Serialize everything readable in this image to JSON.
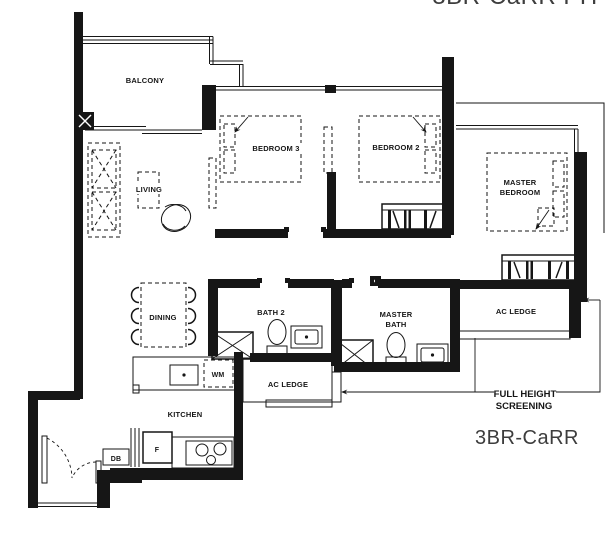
{
  "title": {
    "top_clipped": "3BR-CaRR PH",
    "plan": "3BR-CaRR"
  },
  "rooms": {
    "balcony": "BALCONY",
    "living": "LIVING",
    "bedroom3": "BEDROOM 3",
    "bedroom2": "BEDROOM 2",
    "master_bedroom_l1": "MASTER",
    "master_bedroom_l2": "BEDROOM",
    "dining": "DINING",
    "bath2": "BATH 2",
    "master_bath_l1": "MASTER",
    "master_bath_l2": "BATH",
    "kitchen": "KITCHEN",
    "ac_ledge_mid": "AC LEDGE",
    "ac_ledge_right": "AC LEDGE"
  },
  "appliances": {
    "washer": "WM",
    "fridge": "F",
    "db": "DB"
  },
  "annotations": {
    "screening_l1": "FULL HEIGHT",
    "screening_l2": "SCREENING"
  },
  "colors": {
    "linework": "#161616",
    "title_gray": "#3d3d3d",
    "background": "#ffffff"
  }
}
